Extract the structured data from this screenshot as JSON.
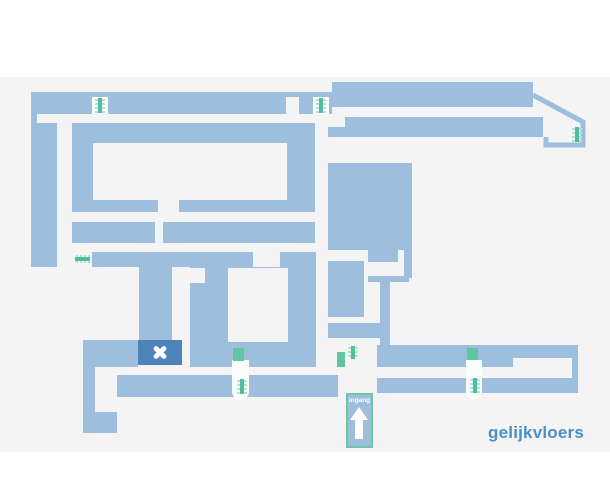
{
  "floor_plan": {
    "floor_label": "gelijkvloers",
    "entrance": {
      "label": "ingang",
      "arrow_icon": "arrow-up-icon"
    },
    "icons": {
      "stairs": "stairs-icon",
      "location_marker": "x-marker-icon"
    },
    "colors": {
      "plan_fill": "#9dbedd",
      "location_block": "#4d83b8",
      "door_green": "#5fc6a2",
      "stairs_green": "#4fbda0",
      "stairs_green_light": "#b2e4d0",
      "background_panel": "#f4f4f5",
      "floor_label_text": "#4a8fc7",
      "marker_cross": "#ffffff",
      "badge_border": "#6fc7a5"
    }
  }
}
